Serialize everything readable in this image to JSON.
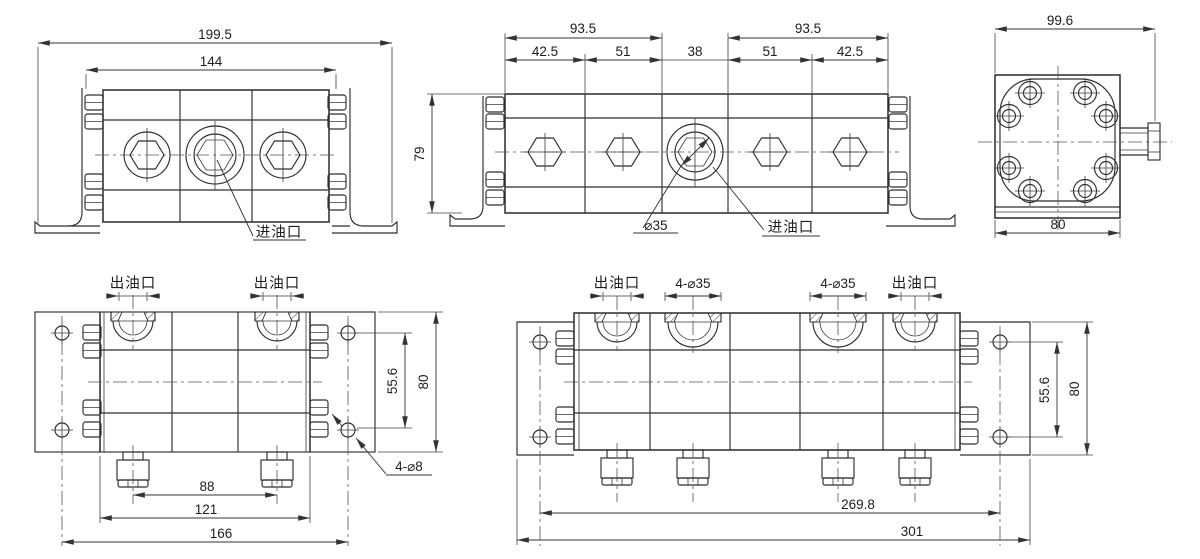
{
  "views": {
    "front2": {
      "dim_overall": "199.5",
      "dim_body": "144",
      "inlet_label": "进油口"
    },
    "front4": {
      "dim_group_left": "93.5",
      "dim_group_right": "93.5",
      "dim_seg1": "42.5",
      "dim_seg2": "51",
      "dim_seg3": "38",
      "dim_seg4": "51",
      "dim_seg5": "42.5",
      "dim_height": "79",
      "bore_note": "⌀35",
      "inlet_label": "进油口"
    },
    "side": {
      "dim_depth": "99.6",
      "dim_width": "80"
    },
    "top2": {
      "outlet_label_left": "出油口",
      "outlet_label_right": "出油口",
      "dim_port_spacing": "88",
      "dim_body_width": "121",
      "dim_hole_spacing": "166",
      "dim_hole_pitch_y": "55.6",
      "dim_depth": "80",
      "mount_hole_note": "4-⌀8"
    },
    "top4": {
      "outlet_label_left": "出油口",
      "outlet_label_right": "出油口",
      "port_note_left": "4-⌀35",
      "port_note_right": "4-⌀35",
      "dim_hole_spacing": "269.8",
      "dim_overall_width": "301",
      "dim_hole_pitch_y": "55.6",
      "dim_depth": "80"
    }
  },
  "colors": {
    "line": "#2e2e2e",
    "dim": "#333333",
    "centerline": "#555555",
    "text": "#1d1d1d",
    "background": "#ffffff"
  }
}
